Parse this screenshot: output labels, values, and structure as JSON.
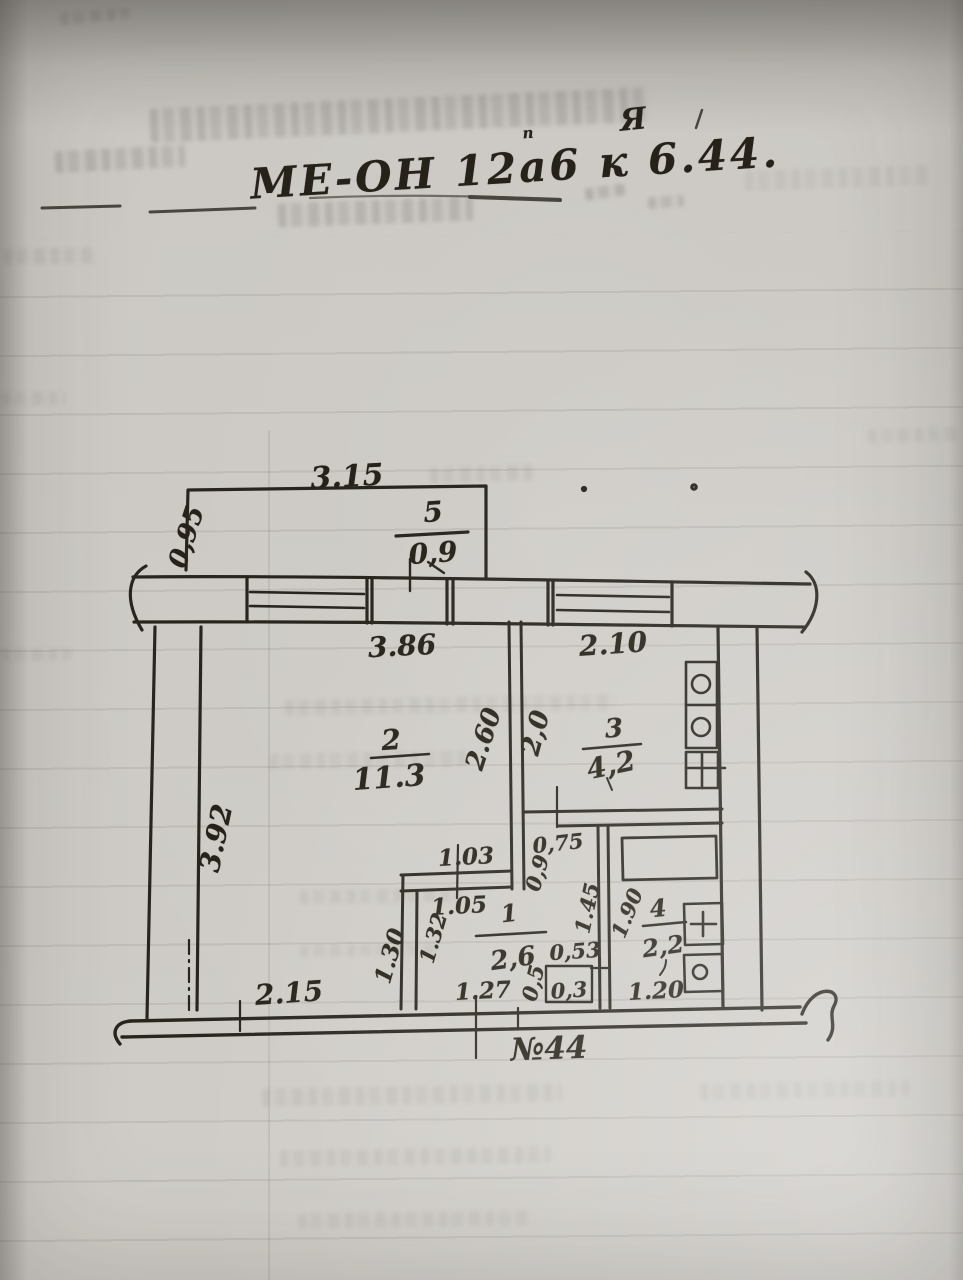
{
  "photo": {
    "description": "Scanned hand-drawn BTI apartment floor plan on aged paper",
    "colors": {
      "paper": "#cdcac5",
      "ink": "#29251e"
    }
  },
  "title": {
    "main": "МЕ-ОН 12а6 к 6.44.",
    "superscript": "Я",
    "diacritic": "п"
  },
  "plan": {
    "apartment_label": "№44",
    "rooms": {
      "balcony": {
        "number": "5",
        "area": "0,9"
      },
      "living": {
        "number": "2",
        "area": "11.3"
      },
      "kitchen": {
        "number": "3",
        "area": "4,2"
      },
      "hall": {
        "number": "1",
        "area": "2,6"
      },
      "bathroom": {
        "number": "4",
        "area": "2,2"
      }
    },
    "dims": {
      "balcony_width": "3.15",
      "balcony_depth": "0,95",
      "living_window": "3.86",
      "kitchen_window": "2.10",
      "living_height": "3.92",
      "living_bottom": "2.15",
      "mid_wall": "2.60",
      "kitchen_width": "2,0",
      "hall_top_upper": "1.03",
      "hall_top_lower": "1.05",
      "kitchen_door": "0,75",
      "hall_passage": "0,9",
      "bath_inner": "1.45",
      "bath_height": "1.90",
      "hall_left_outer": "1.30",
      "hall_left_inner": "1.32",
      "hall_bottom": "1.27",
      "toilet_width": "0,53",
      "toilet_depth_a": "0,5",
      "toilet_depth_b": "0,3",
      "bath_bottom": "1.20"
    }
  }
}
